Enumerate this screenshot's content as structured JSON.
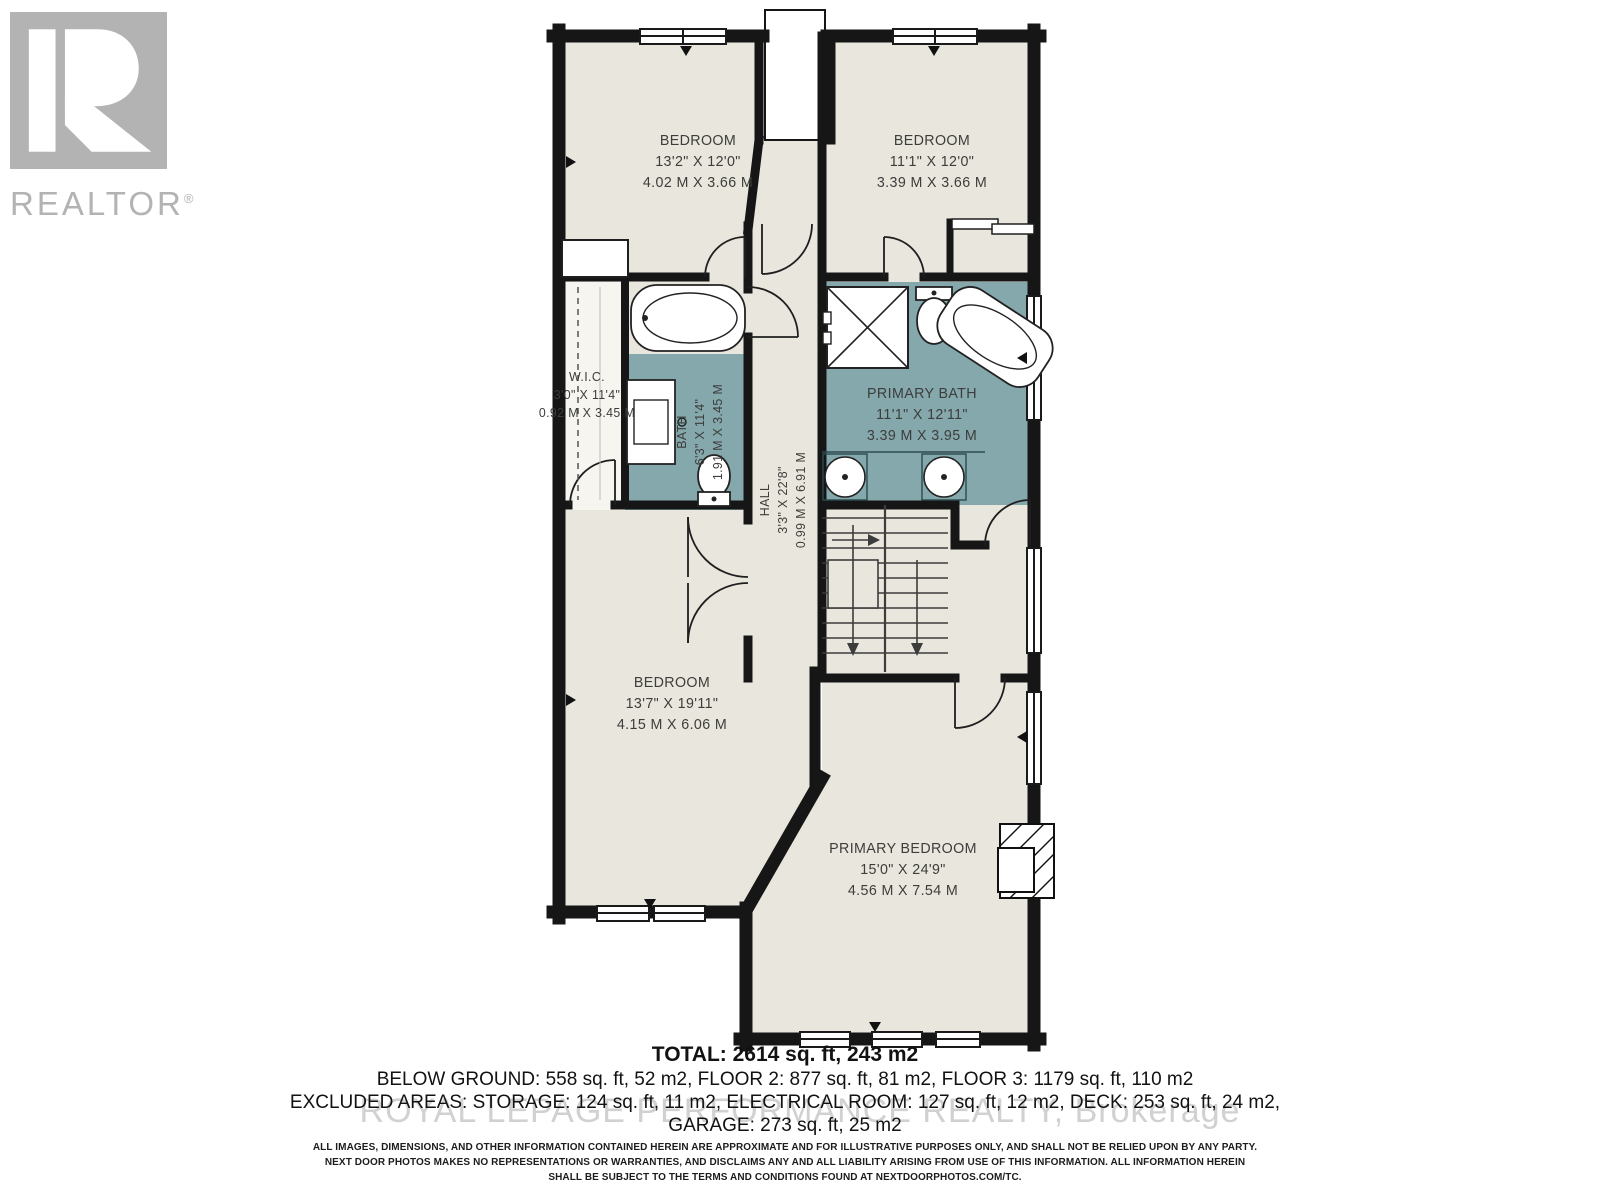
{
  "branding": {
    "logo_text": "REALTOR",
    "logo_reg": "®",
    "logo_symbol": "block-R"
  },
  "watermark": "ROYAL LEPAGE PERFORMANCE REALTY, Brokerage",
  "rooms": [
    {
      "id": "bedroom-top-left",
      "name": "BEDROOM",
      "imperial": "13'2\" X 12'0\"",
      "metric": "4.02 M X 3.66 M"
    },
    {
      "id": "bedroom-top-right",
      "name": "BEDROOM",
      "imperial": "11'1\" X 12'0\"",
      "metric": "3.39 M X 3.66 M"
    },
    {
      "id": "wic",
      "name": "W.I.C.",
      "imperial": "3'0\" X 11'4\"",
      "metric": "0.92 M X 3.45 M"
    },
    {
      "id": "bath",
      "name": "BATH",
      "imperial": "6'3\" X 11'4\"",
      "metric": "1.91 M X 3.45 M"
    },
    {
      "id": "hall",
      "name": "HALL",
      "imperial": "3'3\" X 22'8\"",
      "metric": "0.99 M X 6.91 M"
    },
    {
      "id": "primary-bath",
      "name": "PRIMARY BATH",
      "imperial": "11'1\" X 12'11\"",
      "metric": "3.39 M X 3.95 M"
    },
    {
      "id": "bedroom-lower",
      "name": "BEDROOM",
      "imperial": "13'7\" X 19'11\"",
      "metric": "4.15 M X 6.06 M"
    },
    {
      "id": "primary-bedroom",
      "name": "PRIMARY BEDROOM",
      "imperial": "15'0\" X 24'9\"",
      "metric": "4.56 M X 7.54 M"
    }
  ],
  "summary": {
    "total": "TOTAL: 2614 sq. ft, 243 m2",
    "floors": "BELOW GROUND: 558 sq. ft, 52 m2, FLOOR 2: 877 sq. ft, 81 m2, FLOOR 3: 1179 sq. ft, 110 m2",
    "excluded": "EXCLUDED AREAS: STORAGE: 124 sq. ft, 11 m2, ELECTRICAL ROOM: 127 sq. ft, 12 m2, DECK: 253 sq. ft, 24 m2,",
    "garage": "GARAGE: 273 sq. ft, 25 m2"
  },
  "disclaimer": {
    "line1": "ALL IMAGES, DIMENSIONS, AND OTHER INFORMATION CONTAINED HEREIN ARE APPROXIMATE AND FOR ILLUSTRATIVE PURPOSES ONLY, AND SHALL NOT BE RELIED UPON BY ANY PARTY.",
    "line2": "NEXT DOOR PHOTOS MAKES NO REPRESENTATIONS OR WARRANTIES, AND DISCLAIMS ANY AND ALL LIABILITY ARISING FROM USE OF THIS INFORMATION. ALL INFORMATION HEREIN",
    "line3": "SHALL BE SUBJECT TO THE TERMS AND CONDITIONS FOUND AT NEXTDOORPHOTOS.COM/TC."
  },
  "colors": {
    "floor": "#e9e6dd",
    "bath_floor": "#84a8ac",
    "wall": "#161616",
    "label": "#3d3d3b",
    "logo_gray": "#b3b3b3",
    "watermark_gray": "#c9c9c9"
  }
}
